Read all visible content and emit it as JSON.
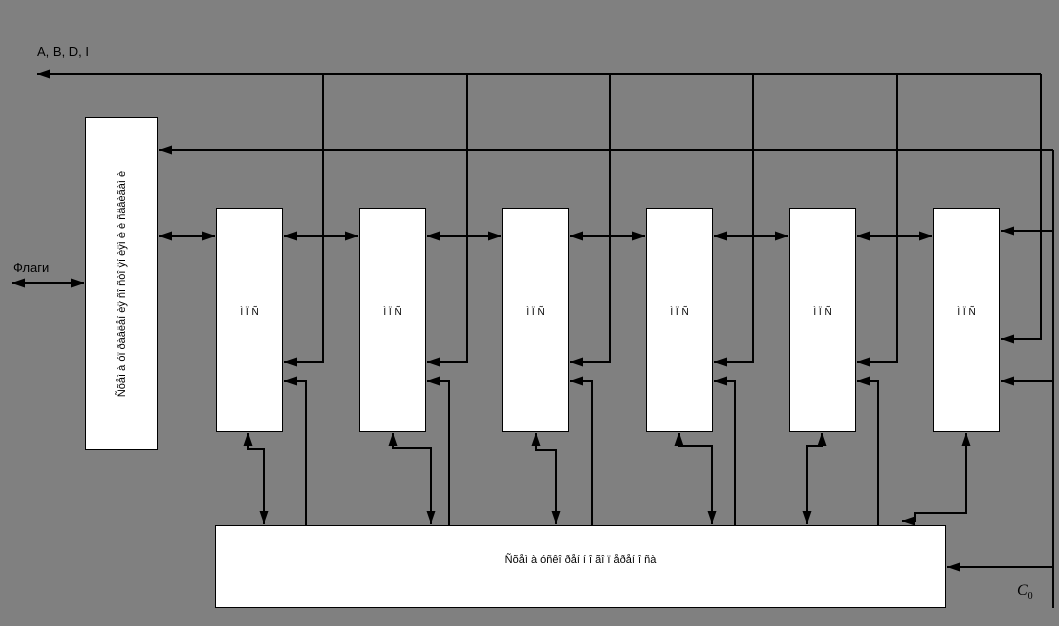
{
  "labels": {
    "top_bus": "A, B, D, I",
    "flags": "Флаги",
    "control_box": "Ñõåì à óï ðàâëåí èÿ ñî ñòî ÿí èÿì è è ñäâèãàì è",
    "carry_box": "Ñõåì à óñêî ðåí í î ãî ï åðåí î ñà",
    "c0_base": "C",
    "c0_sub": "0"
  },
  "sections": [
    {
      "label": "Ì Ï Ñ"
    },
    {
      "label": "Ì Ï Ñ"
    },
    {
      "label": "Ì Ï Ñ"
    },
    {
      "label": "Ì Ï Ñ"
    },
    {
      "label": "Ì Ï Ñ"
    },
    {
      "label": "Ì Ï Ñ"
    }
  ],
  "colors": {
    "background": "#808080",
    "box_fill": "#ffffff",
    "line": "#000000"
  }
}
